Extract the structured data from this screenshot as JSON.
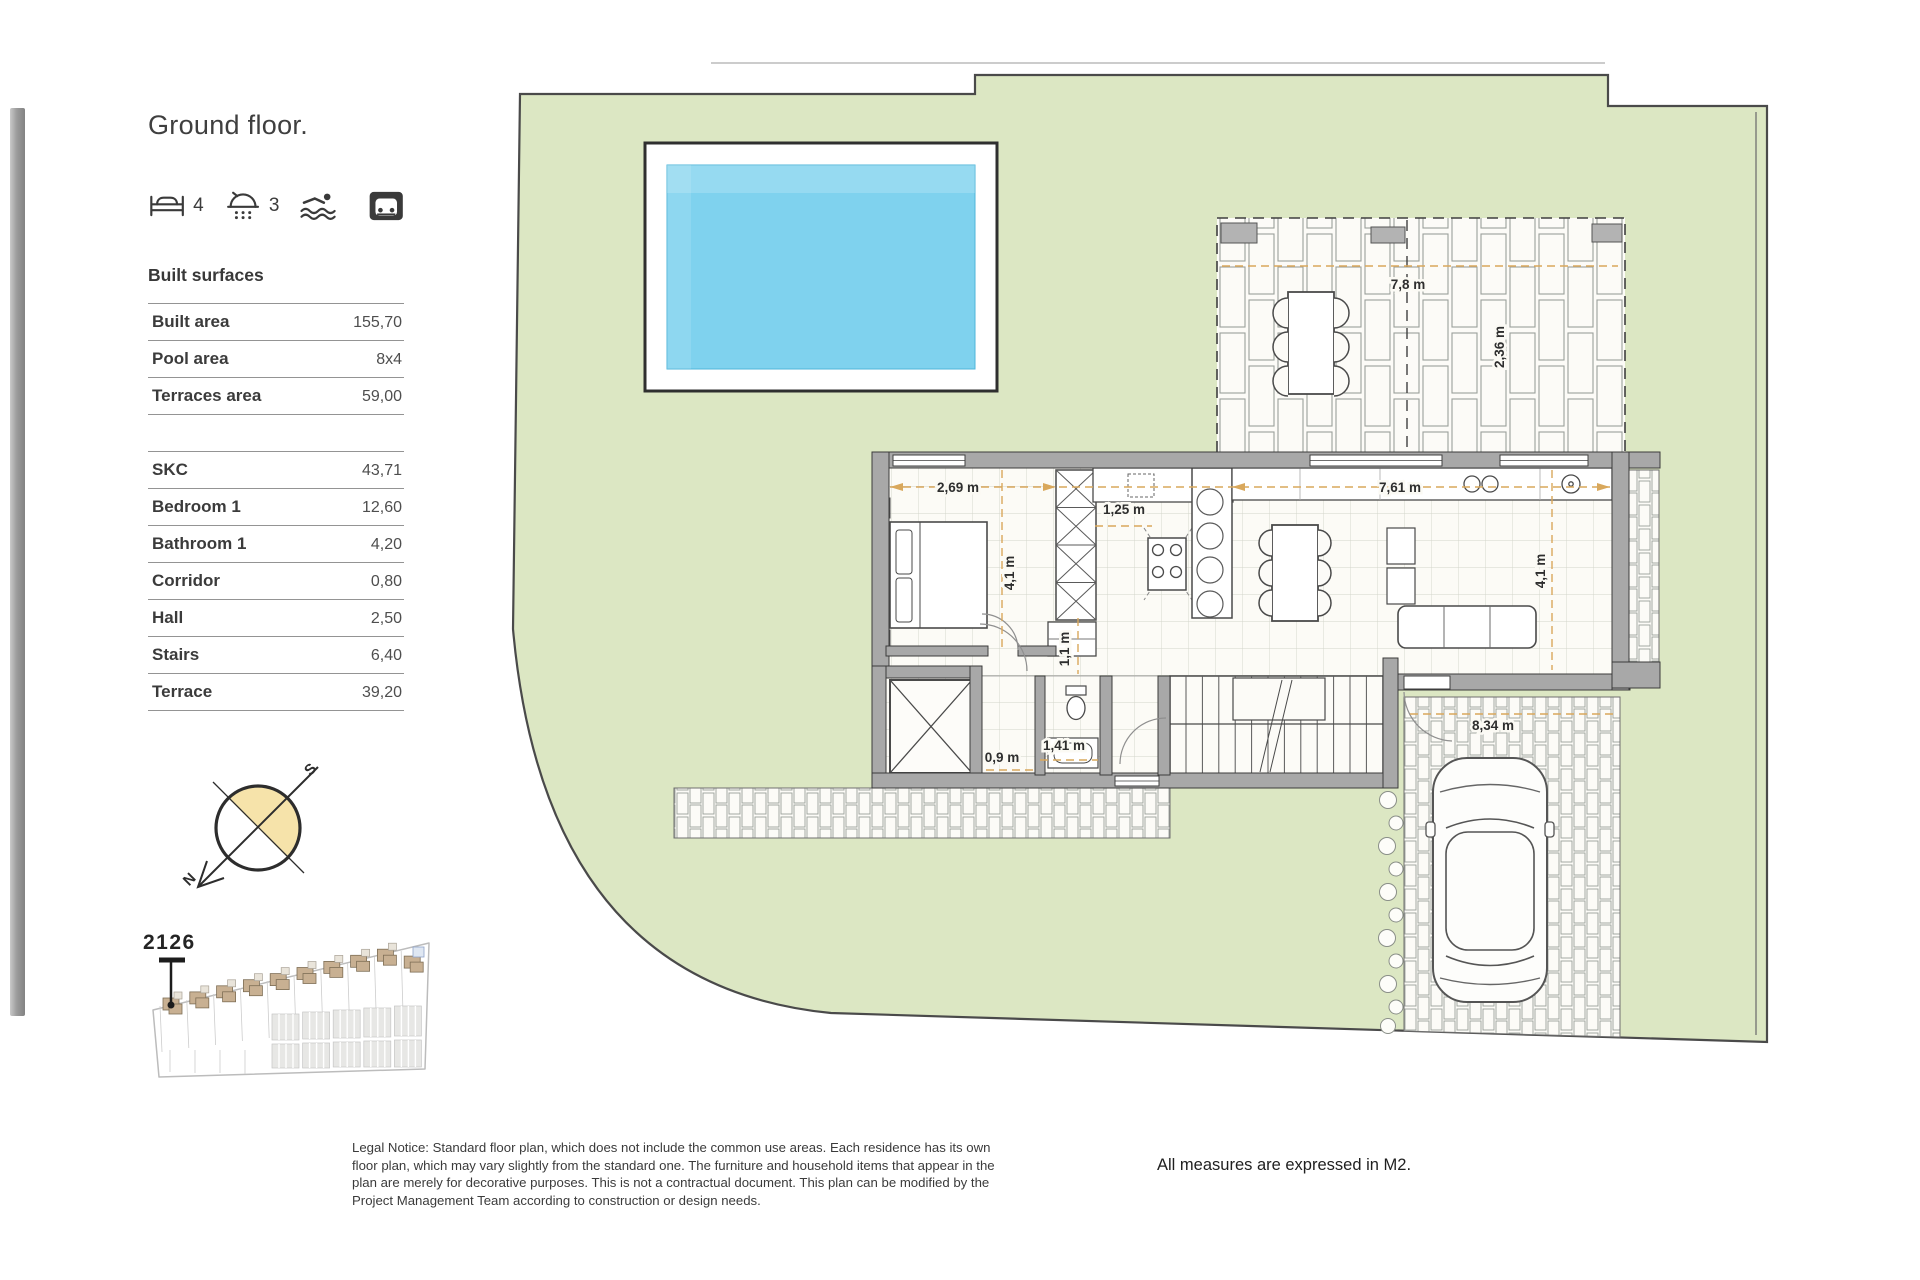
{
  "header": {
    "title": "Ground floor."
  },
  "amenities": {
    "beds": {
      "icon": "bed-icon",
      "count": "4"
    },
    "showers": {
      "icon": "shower-icon",
      "count": "3"
    },
    "pool": {
      "icon": "pool-icon"
    },
    "garage": {
      "icon": "garage-icon"
    }
  },
  "surfaces": {
    "heading": "Built surfaces",
    "summary_rows": [
      {
        "label": "Built area",
        "value": "155,70"
      },
      {
        "label": "Pool area",
        "value": "8x4"
      },
      {
        "label": "Terraces area",
        "value": "59,00"
      }
    ],
    "room_rows": [
      {
        "label": "SKC",
        "value": "43,71"
      },
      {
        "label": "Bedroom 1",
        "value": "12,60"
      },
      {
        "label": "Bathroom 1",
        "value": "4,20"
      },
      {
        "label": "Corridor",
        "value": "0,80"
      },
      {
        "label": "Hall",
        "value": "2,50"
      },
      {
        "label": "Stairs",
        "value": "6,40"
      },
      {
        "label": "Terrace",
        "value": "39,20"
      }
    ]
  },
  "compass": {
    "north": "N",
    "south": "S"
  },
  "siteplan": {
    "unit": "2126"
  },
  "plan": {
    "dims": {
      "bedroom_w": "2,69 m",
      "bedroom_h": "4,1 m",
      "closet_w": "1,25 m",
      "living_w": "7,61 m",
      "living_h": "4,1 m",
      "corridor_w": "1,1 m",
      "hall_l": "1,41 m",
      "hall_w": "0,9 m",
      "terrace_w": "7,8 m",
      "terrace_d": "2,36 m",
      "driveway_l": "8,34 m"
    }
  },
  "footer": {
    "legal": "Legal Notice: Standard floor plan, which does not include the common use areas. Each residence has its own floor plan, which may vary slightly from the standard one. The furniture and household items that appear in the plan are merely for decorative purposes. This is not a contractual document. This plan can be modified by the Project Management Team according to construction or design needs.",
    "measures": "All measures are expressed in M2."
  },
  "colors": {
    "grass": "#dce7c3",
    "pool_water": "#7fd2ee",
    "wall": "#a8a8a8",
    "dimension_line": "#d9a85c",
    "compass_fill": "#f6e3aa",
    "siteplan_house": "#c8b092"
  }
}
